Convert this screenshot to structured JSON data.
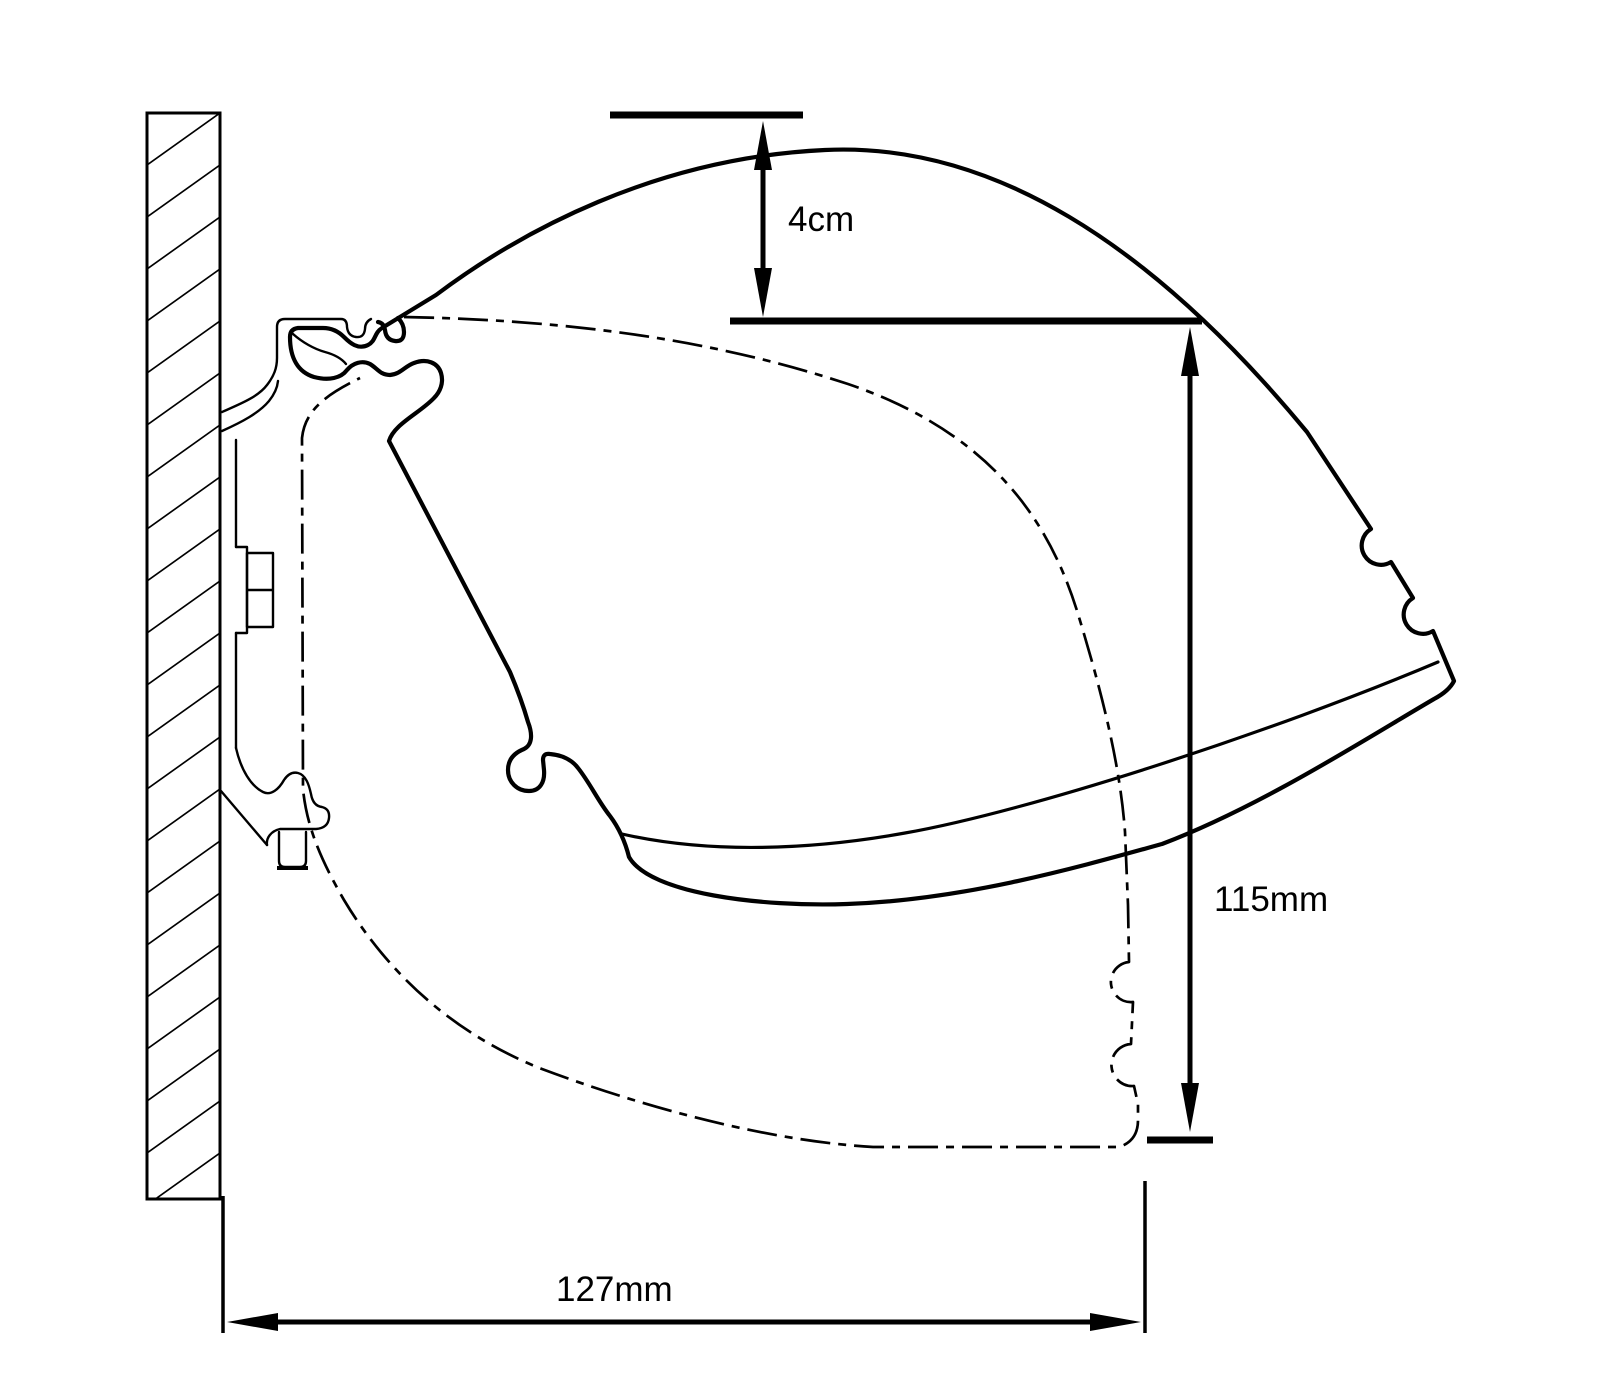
{
  "drawing": {
    "colors": {
      "ink": "#000000",
      "paper": "#ffffff"
    },
    "dims": {
      "drop": {
        "label": "4cm"
      },
      "height": {
        "label": "115mm"
      },
      "depth": {
        "label": "127mm"
      }
    }
  }
}
